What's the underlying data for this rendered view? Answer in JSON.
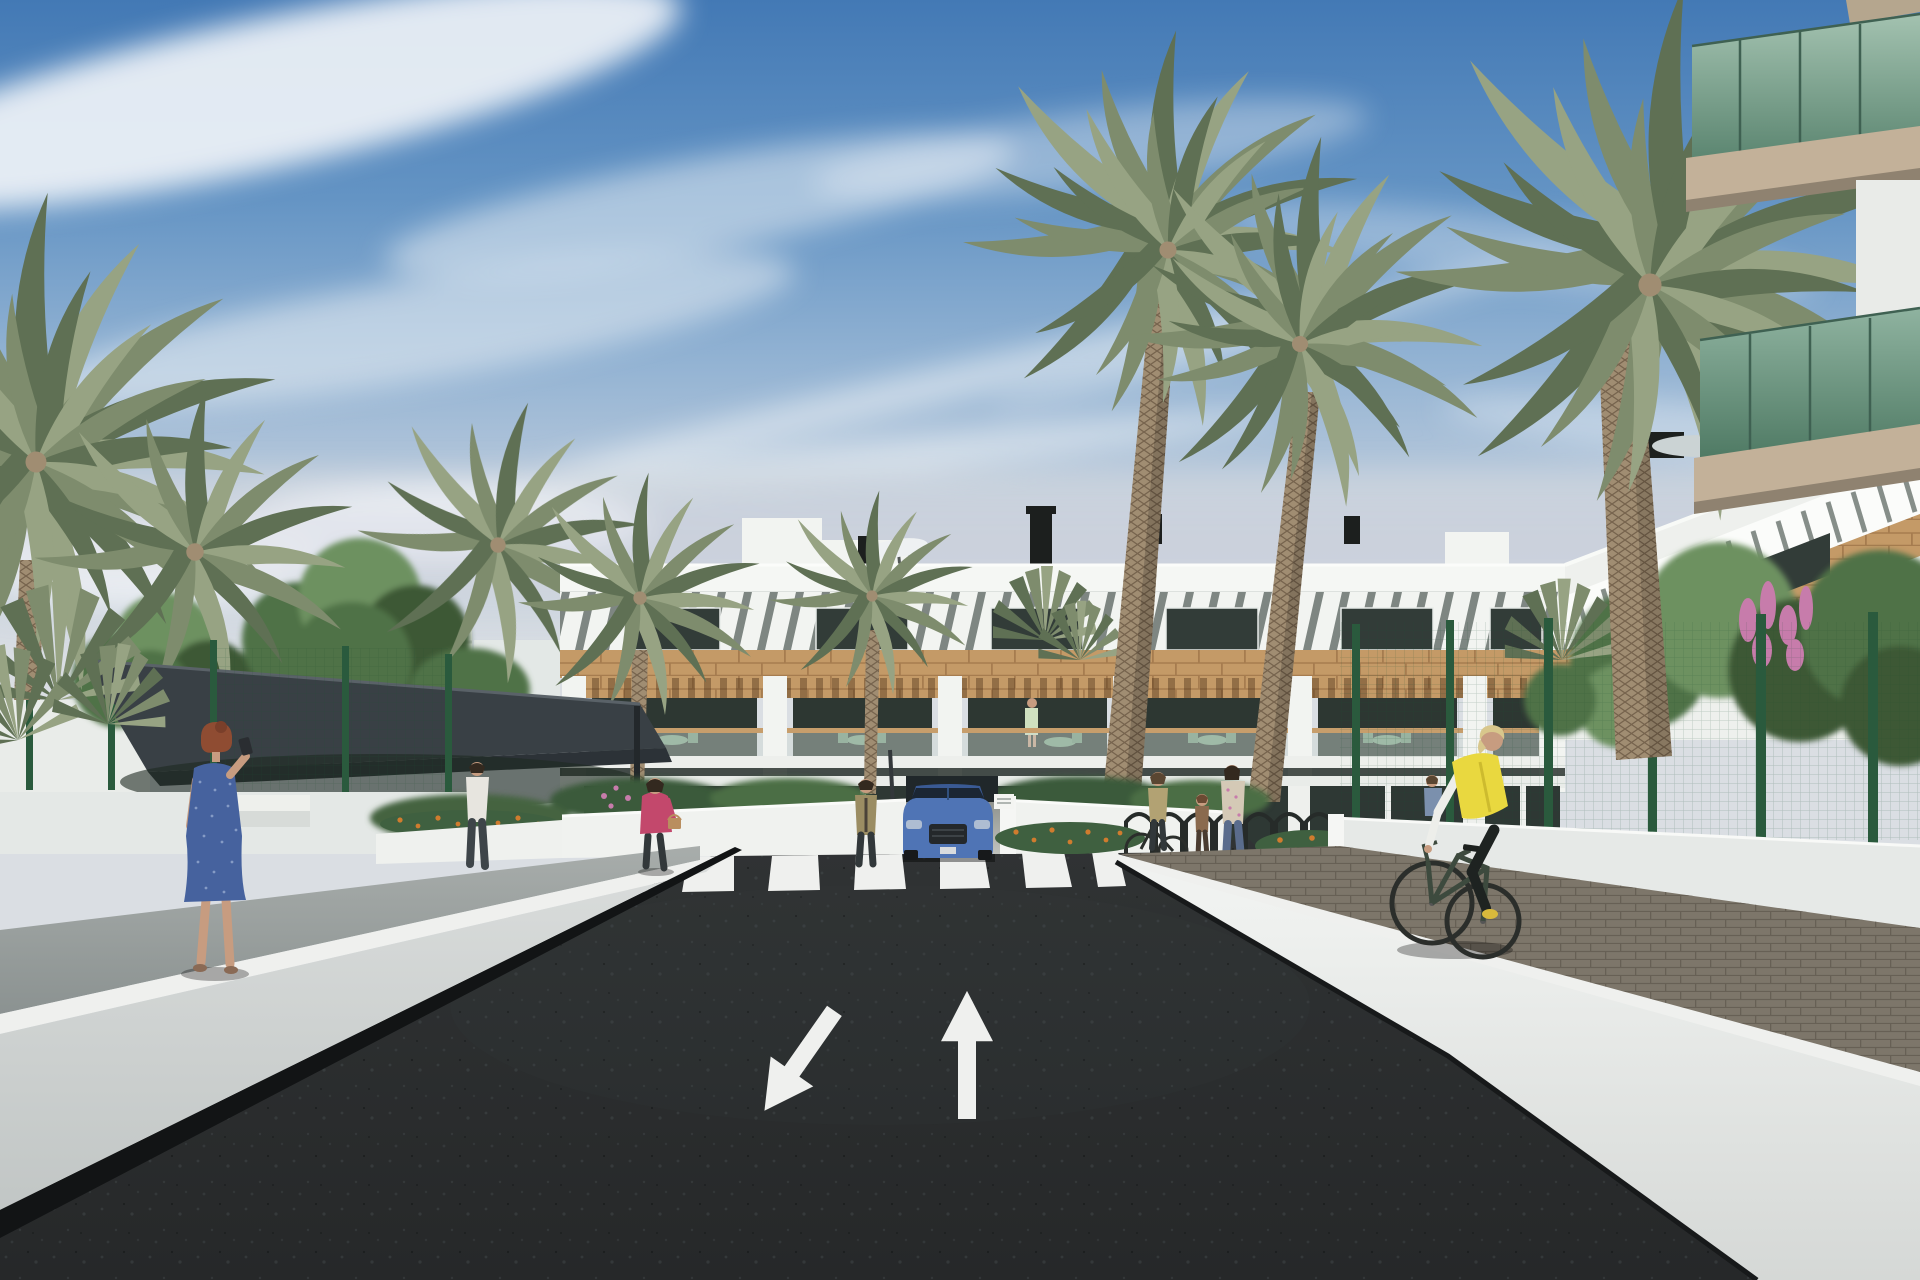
{
  "title": "Architectural 3D render - street view of a modern residential complex",
  "colors": {
    "sky_top": "#4379b5",
    "sky_upper": "#6494c4",
    "sky_mid": "#93b3d3",
    "sky_horizon": "#bfcddd",
    "haze": "#cfd6dd",
    "cloud_white": "#f2f5f8",
    "building_white": "#f2f4f1",
    "building_white_dim": "#dde1de",
    "louver_slat": "#6a736e",
    "window_dark": "#323c38",
    "wood_band": "#c49a67",
    "wood_joint": "#a67c4f",
    "pergola_wood": "#b68d5c",
    "balcony_interior": "#2d3732",
    "railing_cap": "#c79e6c",
    "ground_glass": "#2e3834",
    "glass_green_top": "#a3c2b0",
    "glass_green_bottom": "#5c8671",
    "glass_frame": "#3f6152",
    "balcony_slab_tan": "#c3b199",
    "slab_underside": "#8f8270",
    "palm_green_dark": "#5f7054",
    "palm_green": "#7e8c6d",
    "palm_green_light": "#97a383",
    "palm_trunk": "#a08d72",
    "palm_trunk_shade": "#6f6250",
    "tree_dark": "#3c5836",
    "tree_mid": "#4f7246",
    "tree_light": "#6d9160",
    "sail_dark": "#394045",
    "sail_edge": "#5a6268",
    "sail_under": "#2c3237",
    "fence_post_green": "#2a5a3d",
    "wall_white": "#eff1ee",
    "wall_face_light": "#d9dcdb",
    "walk_gray": "#8f9694",
    "paver_base": "#7d766a",
    "paver_line": "#645e53",
    "road_dark": "#272929",
    "road_speckle": "#4a5154",
    "marking_white": "#eff0ee",
    "concrete_band": "#a8aba5",
    "driveway_light": "#c6c8c3",
    "opening_dark": "#20272a",
    "suv_blue": "#4f74b5",
    "suv_roof": "#3a5a94",
    "suv_glass": "#1b2634",
    "suv_grille": "#24282b",
    "headlight": "#aebdd2",
    "skin": "#c79c80",
    "hair_red": "#8f4c32",
    "hair_blonde": "#d8c78c",
    "hair_dark": "#33291f",
    "hair_brown": "#5a4632",
    "dress_blue": "#46629e",
    "dress_speckle": "#91a5cc",
    "jacket_pink": "#c3486c",
    "handbag_tan": "#b98e5f",
    "shirt_white": "#e7e5df",
    "pants_dark": "#32383a",
    "jeans_blue": "#5a6c8c",
    "vest_yellow": "#e9d83f",
    "shoe_yellow": "#d9ba3c",
    "olive_jacket": "#9b8d63",
    "floral_top": "#d4c9b6",
    "child_top": "#8a6a4e",
    "seated_top": "#7b90ad",
    "balcony_dress": "#cfe0bf",
    "flower_orange": "#d07c2e",
    "flower_pink": "#c77cab",
    "bike_frame": "#3d4a3e",
    "wheel_dark": "#2b2e2b"
  },
  "scene": {
    "description": "Sunny 3D visualization of a modern three-storey apartment complex lined with palm trees; a dark two-way asphalt access road leads to the entrance with painted lane arrows and a zebra crosswalk; white ramp walls flank the road; pedestrians and a cyclist animate the scene.",
    "sky": {
      "condition": "blue with wispy cirrus clouds and pale haze at the horizon"
    },
    "building": {
      "storeys": 3,
      "facade_features": [
        "white parapet",
        "diagonal louvre sun-shade band",
        "dark top-floor windows",
        "timber cladding band",
        "balconies with timber pergolas and glass railings",
        "green outdoor furniture on balconies",
        "dark ground-floor glazing"
      ],
      "roof_items": [
        "white parasol",
        "dark chimneys",
        "stair bulkheads",
        "rooftop AC units",
        "thatch parasol"
      ]
    },
    "foreground_right_building": {
      "balconies": "green glass balustrades with tan concrete slabs, cropped at frame edge"
    },
    "road": {
      "surface": "dark asphalt",
      "markings": {
        "left_lane_arrow": "white arrow pointing toward viewer (down-left)",
        "right_lane_arrow": "white arrow pointing away (up)",
        "crosswalk": "white zebra stripes",
        "small_entry_arrows": "two small opposing arrows at the driveway"
      }
    },
    "vehicle": {
      "type": "SUV",
      "color": "blue",
      "position": "at the residence entrance driveway"
    },
    "people": [
      {
        "id": "woman-blue-dress",
        "description": "red-haired woman in a speckled blue dress taking a photo on the left walkway"
      },
      {
        "id": "woman-pink-jacket",
        "description": "woman in a pink jacket carrying a tan handbag, walking near the entrance"
      },
      {
        "id": "man-white-shirt",
        "description": "man in a white shirt walking along the left fence"
      },
      {
        "id": "woman-at-entrance",
        "description": "woman standing beside the driveway wall"
      },
      {
        "id": "woman-with-bicycle",
        "description": "woman holding a bicycle at the bike racks"
      },
      {
        "id": "child",
        "description": "child standing next to her"
      },
      {
        "id": "woman-floral-top",
        "description": "woman in a floral top and jeans"
      },
      {
        "id": "seated-person",
        "description": "person seated near the right fence"
      },
      {
        "id": "balcony-person",
        "description": "resident standing on a first-floor balcony"
      },
      {
        "id": "cyclist",
        "description": "blonde cyclist in a yellow vest riding on the right paved walkway"
      }
    ],
    "landscape": {
      "palm_trees": 8,
      "fan_palms": 4,
      "green_trees": 6,
      "flowers": [
        "orange marigolds",
        "pink blossoms"
      ],
      "fences": "dark-green mesh security fencing with posts",
      "shade_sail": "dark canopy over the left garden area",
      "bike_racks": 7
    }
  }
}
